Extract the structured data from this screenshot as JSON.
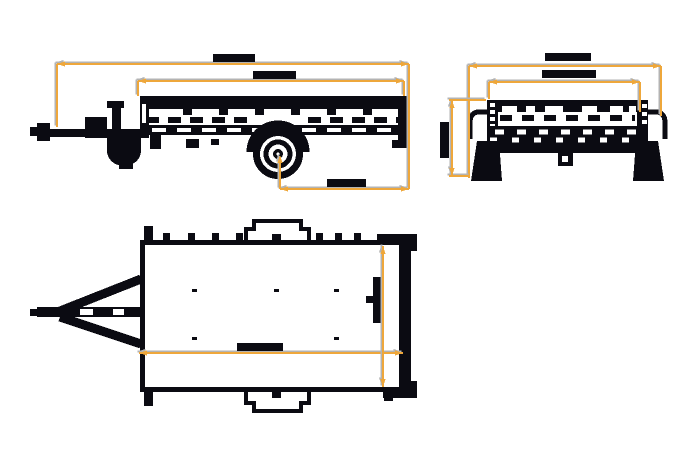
{
  "canvas": {
    "width": 700,
    "height": 467,
    "background": "#ffffff"
  },
  "colors": {
    "linework": "#0b0b12",
    "dimension": "#eea73b",
    "dimension_shadow": "#b3b3b3",
    "paper": "#ffffff"
  },
  "views": [
    "side-view",
    "front-view",
    "top-view"
  ],
  "dimensions": [
    {
      "id": "dim-side-overall-length",
      "view": "side-view",
      "orientation": "h",
      "y": 64,
      "x1": 57,
      "x2": 409,
      "extensions": [
        {
          "x": 57,
          "y1": 64,
          "y2": 127
        },
        {
          "x": 409,
          "y1": 64,
          "y2": 189
        }
      ],
      "label_blob": {
        "x": 213,
        "y": 54,
        "w": 42,
        "h": 8
      }
    },
    {
      "id": "dim-side-bed-length",
      "view": "side-view",
      "orientation": "h",
      "y": 81,
      "x1": 138,
      "x2": 404,
      "extensions": [
        {
          "x": 138,
          "y1": 81,
          "y2": 96
        },
        {
          "x": 404,
          "y1": 81,
          "y2": 96
        }
      ],
      "label_blob": {
        "x": 253,
        "y": 71,
        "w": 43,
        "h": 8
      }
    },
    {
      "id": "dim-side-axle-to-rear",
      "view": "side-view",
      "orientation": "h",
      "y": 189,
      "x1": 280,
      "x2": 409,
      "extensions": [
        {
          "x": 280,
          "y1": 157,
          "y2": 189
        }
      ],
      "extension_arrows": [
        {
          "x": 280,
          "y": 155,
          "dir": "up"
        }
      ],
      "label_blob": {
        "x": 327,
        "y": 179,
        "w": 39,
        "h": 8
      }
    },
    {
      "id": "dim-front-overall-width",
      "view": "front-view",
      "orientation": "h",
      "y": 66,
      "x1": 469,
      "x2": 661,
      "extensions": [
        {
          "x": 469,
          "y1": 66,
          "y2": 178
        },
        {
          "x": 661,
          "y1": 66,
          "y2": 116
        }
      ],
      "label_blob": {
        "x": 545,
        "y": 53,
        "w": 46,
        "h": 8
      }
    },
    {
      "id": "dim-front-box-width",
      "view": "front-view",
      "orientation": "h",
      "y": 82,
      "x1": 489,
      "x2": 640,
      "extensions": [
        {
          "x": 489,
          "y1": 82,
          "y2": 99
        },
        {
          "x": 640,
          "y1": 82,
          "y2": 112
        }
      ],
      "label_blob": {
        "x": 542,
        "y": 70,
        "w": 54,
        "h": 8
      }
    },
    {
      "id": "dim-front-height",
      "view": "front-view",
      "orientation": "v",
      "x": 452,
      "y1": 100,
      "y2": 176,
      "extensions": [
        {
          "y": 100,
          "x1": 449,
          "x2": 486
        },
        {
          "y": 176,
          "x1": 449,
          "x2": 470
        }
      ]
    },
    {
      "id": "dim-top-length",
      "view": "top-view",
      "orientation": "h",
      "y": 353,
      "x1": 139,
      "x2": 403,
      "label_blob": {
        "x": 237,
        "y": 343,
        "w": 46,
        "h": 8
      }
    },
    {
      "id": "dim-top-width",
      "view": "top-view",
      "orientation": "v",
      "x": 383,
      "y1": 246,
      "y2": 387
    }
  ]
}
